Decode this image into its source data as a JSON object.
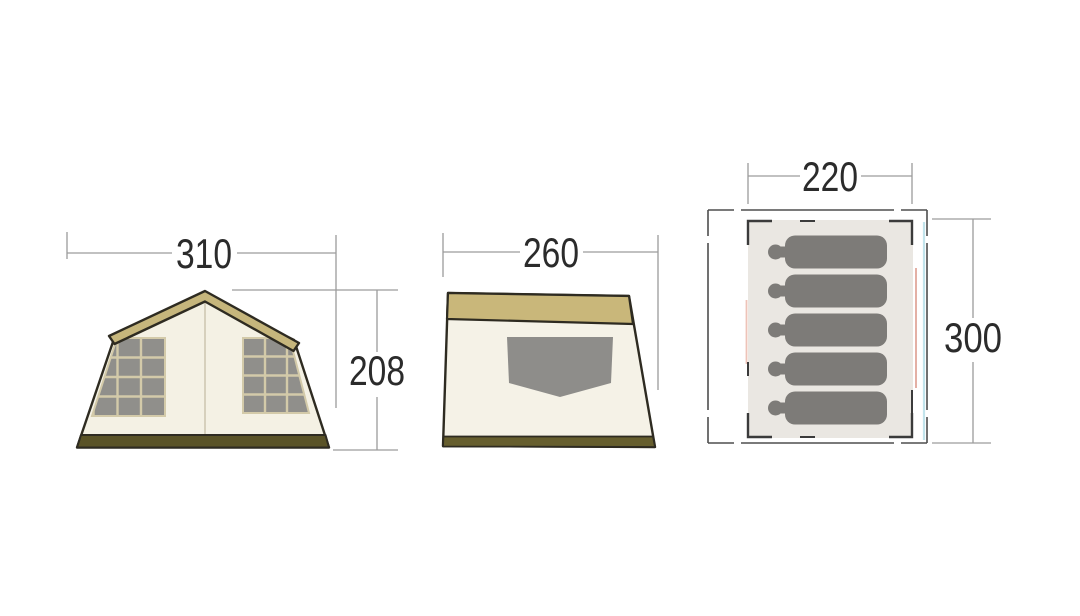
{
  "diagram": {
    "background_color": "#ffffff",
    "subject": "tent-three-view-dimension-diagram",
    "front_view": {
      "width_label": "310",
      "height_label": "208",
      "window_count": 2,
      "canvas_color": "#f4f1e4",
      "roof_band_color": "#c6b67c",
      "outline_color": "#2e2b21",
      "skirt_color": "#5a5327",
      "window_color": "#908f8b",
      "mullion_color": "#d3caa9"
    },
    "side_view": {
      "depth_label": "260",
      "canvas_color": "#f5f2e7",
      "roof_band_color": "#c9b77a",
      "skirt_color": "#665e2e",
      "pocket_color": "#8e8d8a"
    },
    "floor_plan": {
      "width_label": "220",
      "depth_label": "300",
      "occupant_count": 5,
      "floor_color": "#eae7e2",
      "groundsheet_outline_color": "#4e4e4e",
      "corner_bracket_color": "#3b3b3b",
      "person_color": "#7d7b78",
      "left_accent_color": "#eec3b8",
      "right_accent_color": "#e2a79b",
      "outer_accent_color": "#c2e4ec"
    },
    "dimension_style": {
      "line_color": "#9c9c9c",
      "text_color": "#2b2b2b"
    },
    "person_geometry": {
      "body_x": 785,
      "first_center_y": 252,
      "row_spacing": 39
    }
  }
}
